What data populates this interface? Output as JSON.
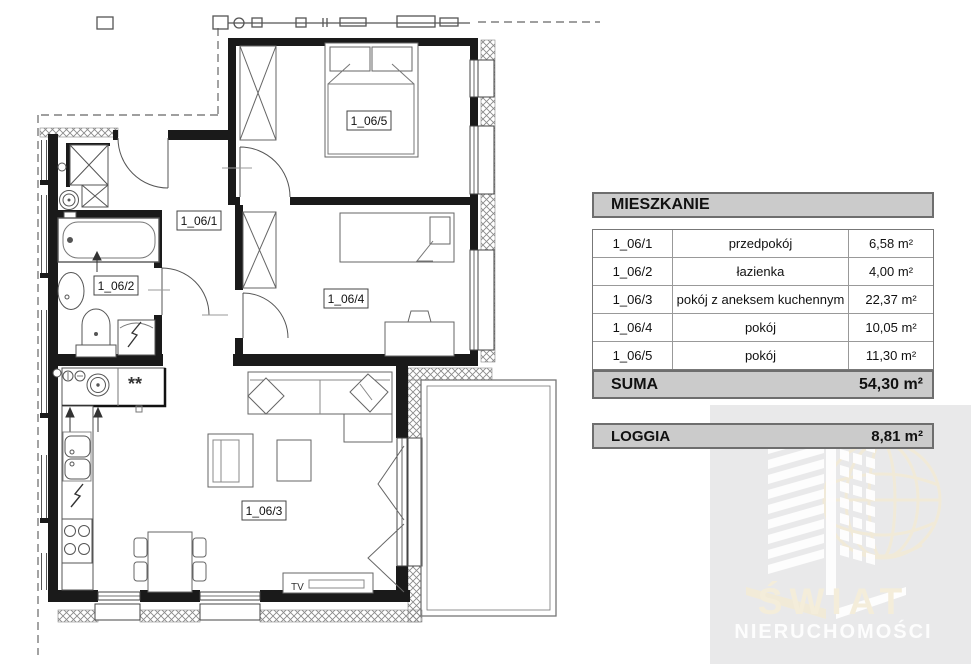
{
  "plan": {
    "room_labels": [
      "1_06/1",
      "1_06/2",
      "1_06/3",
      "1_06/4",
      "1_06/5"
    ],
    "tv_label": "TV",
    "kitchen_marks": "**"
  },
  "table": {
    "header": "MIESZKANIE",
    "rows": [
      {
        "id": "1_06/1",
        "name": "przedpokój",
        "area": "6,58 m²"
      },
      {
        "id": "1_06/2",
        "name": "łazienka",
        "area": "4,00 m²"
      },
      {
        "id": "1_06/3",
        "name": "pokój z aneksem kuchennym",
        "area": "22,37 m²"
      },
      {
        "id": "1_06/4",
        "name": "pokój",
        "area": "10,05 m²"
      },
      {
        "id": "1_06/5",
        "name": "pokój",
        "area": "11,30 m²"
      }
    ],
    "suma": {
      "label": "SUMA",
      "area": "54,30 m²"
    },
    "loggia": {
      "label": "LOGGIA",
      "area": "8,81 m²"
    }
  },
  "watermark": {
    "line1": "ŚWIAT",
    "line2": "NIERUCHOMOŚCI"
  },
  "colors": {
    "wall": "#1a1a1a",
    "table_fill": "#cbcbcb",
    "table_border": "#6e6e6e",
    "watermark_bg": "#e9e9ea",
    "watermark_cream": "#f4edda",
    "watermark_white": "#fdfdfd"
  }
}
